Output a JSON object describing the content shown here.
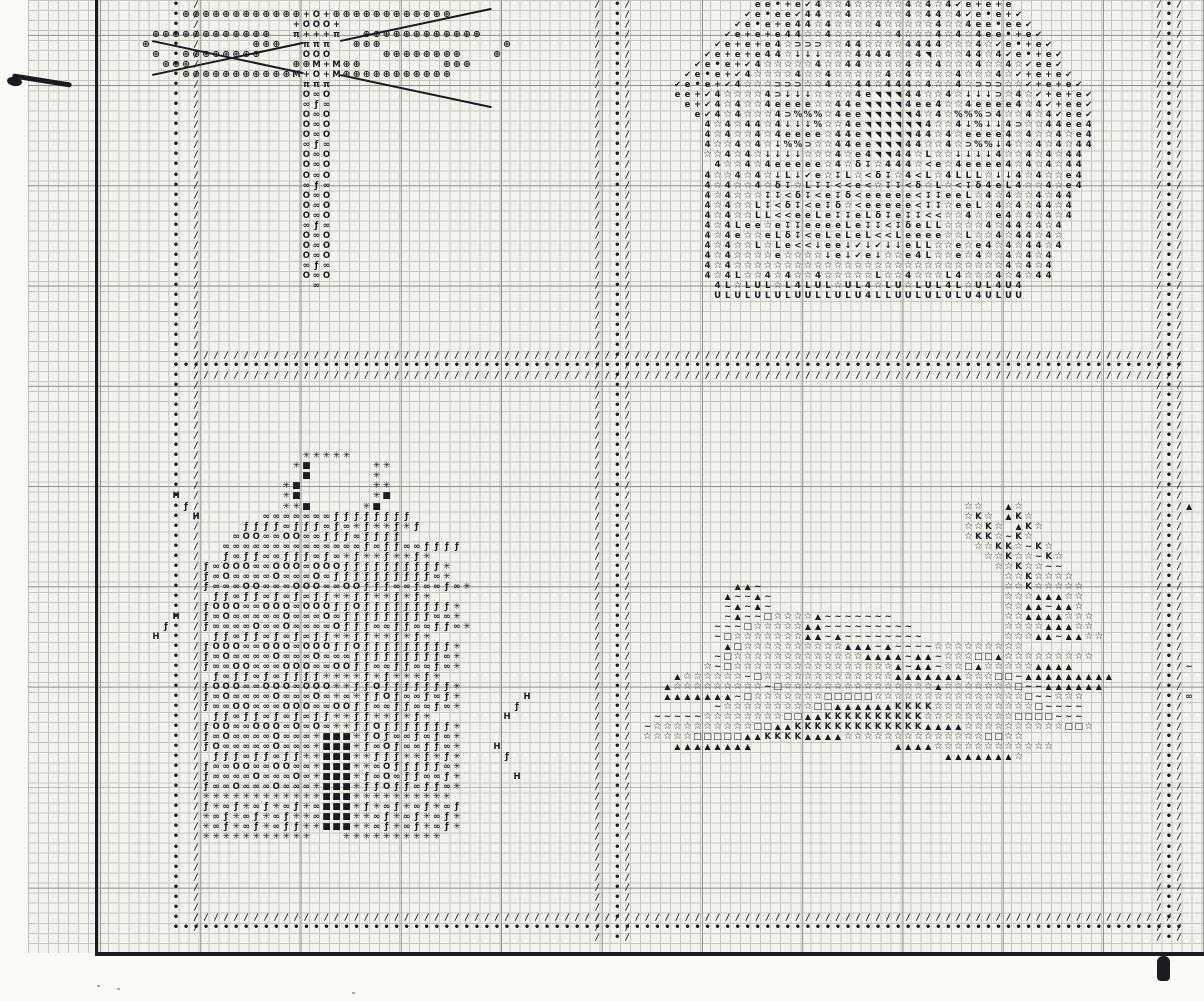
{
  "meta": {
    "description": "Scanned cross-stitch pattern chart page with four symbol motifs"
  },
  "palette": {
    "paper": "#f3f2ec",
    "paper_outside": "#fbfaf6",
    "grid_minor": "#c7c7c0",
    "grid_major": "#92928b",
    "ink": "#1b1b20"
  },
  "grid": {
    "cell": 10.03,
    "cols": 120,
    "rows": 95,
    "major_every": 10
  },
  "legend": {
    "symbols": {
      ".": "•",
      "/": "/",
      "P": "⊕",
      "+": "+",
      "0": "O",
      "O": "O",
      "p": "π",
      "8": "∞",
      "f": "ƒ",
      "M": "M",
      "e": "e",
      "v": "✔",
      "4": "4",
      "s": "☆",
      "D": "⊃",
      "d": "↓",
      "%": "%",
      "T": "◥",
      "L": "L",
      "U": "U",
      "<": "<",
      "g": "δ",
      "J": "↧",
      "*": "✳",
      "#": "■",
      "H": "H",
      "A": "▲",
      "~": "~",
      "q": "□",
      "K": "K"
    }
  },
  "dividers": {
    "left": {
      "cols": [
        [
          17,
          "."
        ],
        [
          19,
          "/"
        ]
      ],
      "row_start": 0,
      "row_end": 92
    },
    "mid": {
      "cols": [
        [
          59,
          "/"
        ],
        [
          61,
          "."
        ],
        [
          62,
          "/"
        ]
      ],
      "row_start": 0,
      "row_end": 93
    },
    "right": {
      "cols": [
        [
          115,
          "/"
        ],
        [
          116,
          "."
        ],
        [
          117,
          "/"
        ]
      ],
      "row_start": 0,
      "row_end": 93
    },
    "h_bands": [
      {
        "row": 35,
        "ch": "/",
        "col_start": 19,
        "col_end": 117
      },
      {
        "row": 36,
        "ch": ".",
        "col_start": 17,
        "col_end": 117
      },
      {
        "row": 37,
        "ch": "/",
        "col_start": 19,
        "col_end": 117
      },
      {
        "row": 91,
        "ch": "/",
        "col_start": 19,
        "col_end": 117
      },
      {
        "row": 92,
        "ch": ".",
        "col_start": 17,
        "col_end": 117
      }
    ]
  },
  "regions": [
    {
      "name": "dragonfly-motif",
      "x": 14,
      "y": 1,
      "rows": [
        "    PPPPPPPPPPPP+0+PPPPPPPPPPPP",
        "               +000+",
        " PPPPPPPPPPPP  p+++p  PPPPPPPPPPPP",
        "P          PPP  ppp  PPP            P",
        " P  PPPPPPPP    000     PPPPPPPP   P",
        "  PPP          PPM+MPP        PPP",
        "    PPPPPPPPPPPM+0+MPPPPPPPPPPP",
        "                ppp",
        "                O8O",
        "                8f8",
        "                O8O",
        "                O8O",
        "                O8O",
        "                8f8",
        "                O8O",
        "                O8O",
        "                O8O",
        "                8f8",
        "                O8O",
        "                O8O",
        "                O8O",
        "                8f8",
        "                O8O",
        "                O8O",
        "                O8O",
        "                8f8",
        "                O8O",
        "                 8"
      ]
    },
    {
      "name": "flower-basket-motif",
      "x": 64,
      "y": 0,
      "rows": [
        "           ee.+ev4ss4sssss4s4s4ve+e+e",
        "          ve.eev44ss4sssss4s44s4ve.e+v",
        "         ve.e+e44s4ssss4sssss4ss4ee.eev",
        "        ve+e+e44ss4ssssss4sss4s4s4ee.+ev",
        "       ve+e+e4sDDDss44ssss4444sss4sve.+ev",
        "      ve+e+e44sdddsss4444ss4Tsss44s4ve.+ev",
        "     ve.e+v4sssss4ss44ssss4ss4sss4ss4sveev",
        "    ve.e+v4ssss4ss4sssss4s4ssss4sss4sv+e+ev",
        "   ve.e+v4sssDDDss4ss44s444s4ss4sDDDssv+e+ev",
        "   ee+v4ssss4Ddddssss4eTTT44ss4sdddDs4sv+e+ev",
        "    e+v4s4ss4eeeess44eTTTT4ee4ss4eeee4s4v+eev",
        "     ev4s4sss4D%%%s4eeTTTTT4s4s%%%D4ss4s4veev",
        "      4s4s44s4ddd%ss4eTTTTTT4ss4d%dd4Dss44ee4",
        "      4s4ss4s4eeees44eTTTTT44s4seeee4s4ss4se4",
        "      4ss4s4sd%%Dss44eeTTT44ss4sD%%d4ss4s4s44",
        "      ss4s4sddddsss4se4TT44sLssdddd4ss4s4s44",
        "       4ss4s4eeeees4sgJs444s<es4eeee4s4s4s44",
        "      4ss4s4sdLdvesJLs<gJs4<Ls4LLLsdd4s4sse4",
        "      4s4ss4sgJsLJJ<<e<sJJ<gsLs<Jg4eL4ss4se4",
        "      4s4sssJJ<gJ<eJg<eeeee<JJeeLs4s4ss4s44",
        "      4s4ssLJ<gJ<eJgs<eeeee<JJseeLs4s4s44s4",
        "      4s4ssLL<<eeLeJJeLgJeJJ<<ss4sse4s4s4s4",
        "      4s4LeeseJJeeeeLeJJ<JgeLLssss4s44s4s4",
        "      4s4esseLgJ<eLeLeL<<LeeeessLss4s44s4s",
        "      4s4ssLsLe<<deedvdvddeLLssese4s4s44s4",
        "      4s4ssssessssdedvedsse4Lsses4ss4s4s4",
        "      4s4sssssssssssssssssssssssssss4s4s4",
        "      4s4Lss4s4ss4sssssLss4sssL4sss4s4s44",
        "       4LsLULsL4LULsUL4sLUsLUL4LsUL4U4",
        "       ULULULULUULLULU4LLUULULULU4ULUU"
      ]
    },
    {
      "name": "beehive-motif",
      "x": 19,
      "y": 45,
      "rows": [
        "           *****",
        "          *#      **",
        "           #      *",
        "         *#       **",
        "         *#       *#",
        "         **#     *#",
        "       8888888ffffffff",
        "     ffff8fff8f8*f**f*f",
        "    8OO88OO88fff8ffff",
        "   88888888888888f8ff88ffff",
        "   f8ff88fff8f8*f**f**f*",
        " f8OOO88OOO8OOOffffffffff*",
        " f8O8888O888O8ffffffffff8*",
        " f888OO888OOO88OOfff88f88f8*",
        "  ff8ff8f8f8ff**ff**f*f*",
        " fOOO88OOO8OOOffOfffffffff*",
        " f8O88888O888O8fffffffff88*",
        " f8888O88O8888Offf88ff88ff8*",
        "  ff8ff8f8f8ff**ff**f*f*",
        " fOOO88OOO8OOOffOfffffffff*",
        " f8O8888O888O888fffffffff8*",
        " f88OO888OOO88OOff88ff88f8*",
        "  f8ff8f8ffff****f*f***f*",
        " fOOO88OOO8OOO**ffOfffffff*",
        " f8O8888O888O8*8*ffOf88f8f*",
        " f88OO888OOO88OOff88ff88f8*",
        "  ff8ff8f8f8ff**ff**f*f*",
        " fOO88OOO8O8O8**ffOfffffff*",
        " f8O8888O888*###*fOf88f8f8*",
        " fO88888O888*###*f8Of88ff8*",
        "  fff8ff8ff**###**fff**f*f*",
        " f88OO88OO88*###**8Offfff8*",
        " f8888O888O8*###*f8O8ff88f*",
        " f88O888O888*###*ffOff8ff8*",
        " ************###**********",
        " f*8f*8f*8f*8###*f*8f*8f*8f",
        " *8f*8f*8f**8###**8f*8f*8f*",
        " *8f*8f*8ff**###**8f*8f*8f*",
        " ***********   **********"
      ]
    },
    {
      "name": "sleigh-motif",
      "x": 63,
      "y": 50,
      "rows": [
        "                                 ss  As",
        "                                 sKs AKs",
        "                                 ssKs AKs",
        "                                 sKKs~Ks",
        "                                  ssKKs~Ks",
        "                                   ssKss~Ks",
        "                                    ssKss~~",
        "                                     ssKssss",
        "          AA~                        ssKsssss",
        "         A~~A~                       sssAAAss",
        "         ~A~A~                       ssAA~AAs",
        "         ~A~~qssssA~~~~~~~           ssAAAAsss",
        "        ~~~qsssssAA~~~~~~~~~         ssssAAAss",
        "        ~qsssssssAA~A~~~~~~~~        sssAA~AAss",
        "         AqssssssssssAAA~A~~~~sssssssss",
        "        ~qsssssssssssssAAAA~AA~sssqqAsssssssss",
        "       s~qssssssssssssssssA~AA~ssqAsssssAAAA",
        "    Assssss~qsssssssssssssAAAAAAAsssqq~AAAAAAAAA",
        "   Asssssssss~qsssssssssssssssAsssssssq~~AAAAAA",
        "   AAAAAAA~qsssssssqqqqqsssssssssssssssq~~sss",
        "        ~sssssssssqqAAAAAAKKKKssssssssssq~~~~",
        "  ~~~~~ssssssssqqAAKKKKKKKKKKsssssssssqqqq~~~",
        " ~ssssssssssqqAAKKKKKKKKKKKKKAAAAssssssssssqqs",
        " sssssqqqqqAAKKKKAAAAssssssssssssssqqss",
        "    AAAAAAAA              AAAAssssssssssss",
        "                               AAAAAAAs"
      ]
    },
    {
      "name": "scattered-bee-marks",
      "x": 0,
      "y": 0,
      "scatter": [
        [
          17,
          49,
          "H"
        ],
        [
          18,
          50,
          "f"
        ],
        [
          19,
          51,
          "H"
        ],
        [
          17,
          61,
          "H"
        ],
        [
          16,
          62,
          "f"
        ],
        [
          15,
          63,
          "H"
        ],
        [
          52,
          69,
          "H"
        ],
        [
          51,
          70,
          "f"
        ],
        [
          50,
          71,
          "H"
        ],
        [
          49,
          74,
          "H"
        ],
        [
          50,
          75,
          "f"
        ],
        [
          51,
          77,
          "H"
        ],
        [
          118,
          50,
          "A"
        ],
        [
          118,
          66,
          "~"
        ],
        [
          118,
          69,
          "8"
        ]
      ]
    }
  ],
  "strokes": [
    {
      "x": 152,
      "y": 40,
      "len": 155,
      "deg": 12
    },
    {
      "x": 152,
      "y": 74,
      "len": 155,
      "deg": -12
    },
    {
      "x": 340,
      "y": 74,
      "len": 155,
      "deg": 12
    },
    {
      "x": 340,
      "y": 40,
      "len": 155,
      "deg": -12
    }
  ],
  "marks": {
    "speckles": [
      [
        97,
        985
      ],
      [
        117,
        988
      ],
      [
        352,
        992
      ]
    ]
  }
}
